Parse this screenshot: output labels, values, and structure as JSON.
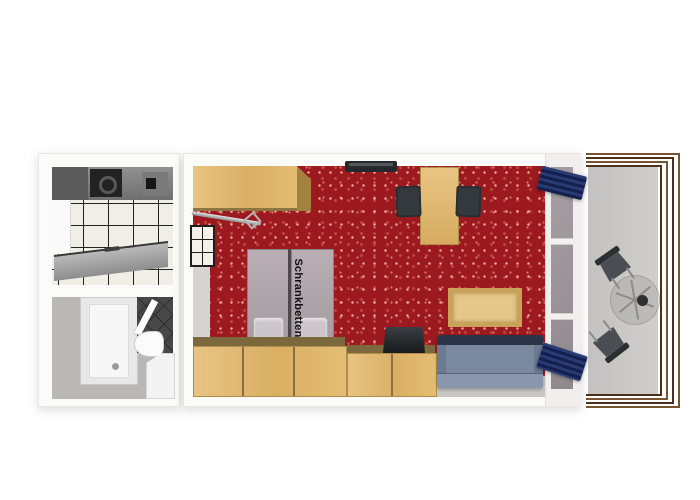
{
  "floorplan": {
    "bed_label": "Schrankbetten",
    "colors": {
      "carpet": "#9c191f",
      "carpet_dot": "#c2483c",
      "wood": "#d9af63",
      "wood_top": "#7b683c",
      "mattress": "#a49ba0",
      "pillow": "#ccc5c9",
      "sofa_body": "#7b89a0",
      "sofa_back": "#2b3446",
      "curtain_light": "#2a3a74",
      "curtain_dark": "#13204d",
      "glass": "#8f898d",
      "railing": "#7a5330",
      "railing_dark": "#4c3118",
      "tile": "#f1eee8",
      "grout": "#23231f",
      "dark_tile": "#474747",
      "floor_gray": "#c9c8c5"
    }
  }
}
